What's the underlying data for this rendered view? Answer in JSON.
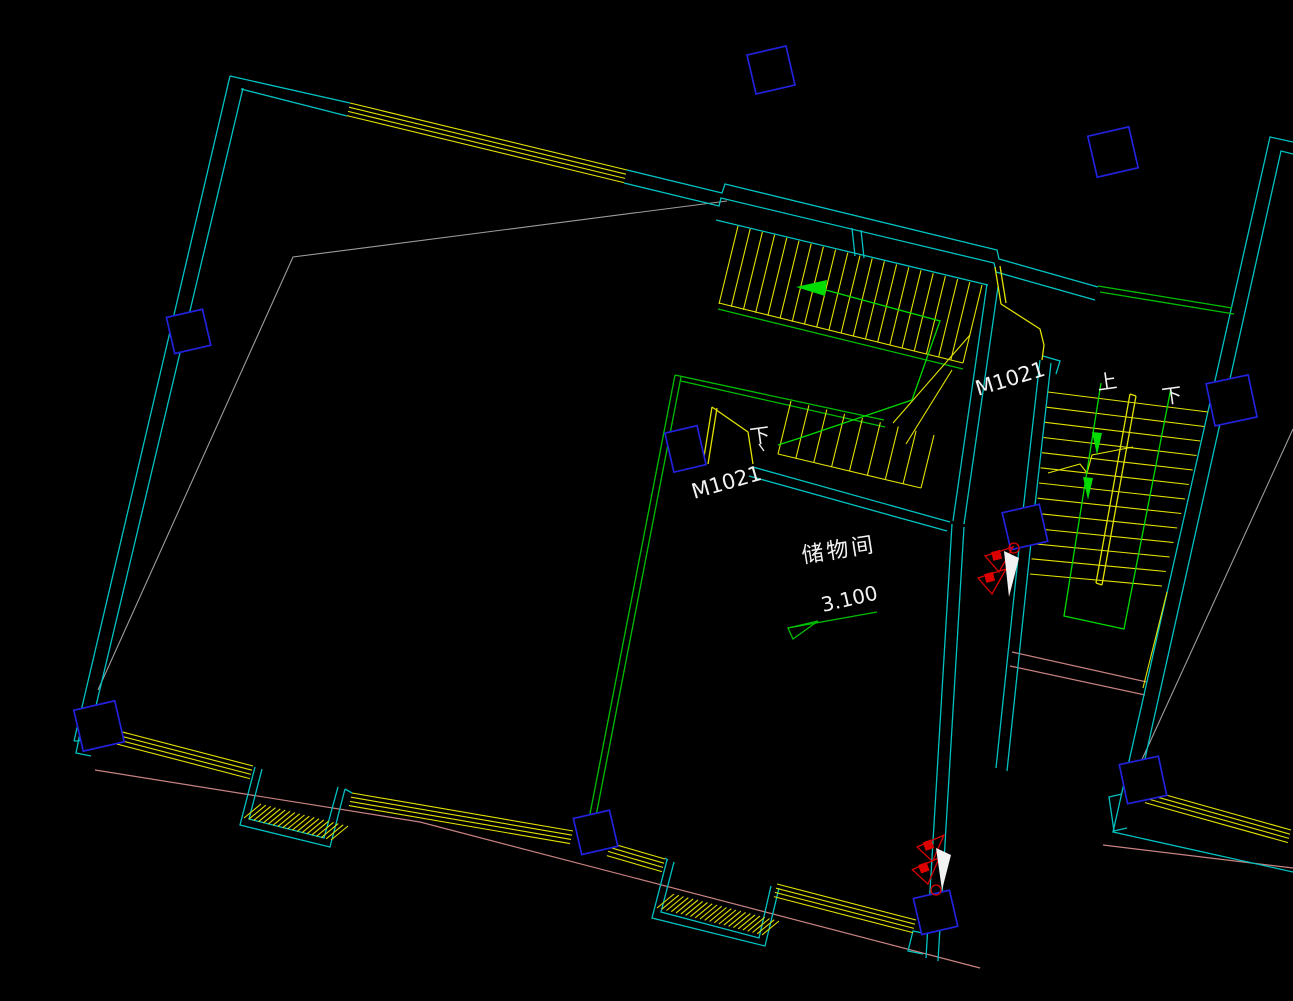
{
  "title": "CAD floor plan - storage room level",
  "palette": {
    "background": "#000000",
    "wall": "#00C2C2",
    "window": "#E2E200",
    "green": "#00BE00",
    "arrow_green": "#00DC00",
    "column_blue": "#2222DC",
    "red": "#DC0000",
    "white": "#F2F2F2",
    "gray": "#9C9C9C",
    "pink": "#C88282"
  },
  "labels": {
    "door_left": "M1021",
    "door_right": "M1021",
    "down_left": "下",
    "up_right": "上",
    "down_right": "下",
    "room_name": "储物间",
    "room_elevation": "3.100"
  }
}
